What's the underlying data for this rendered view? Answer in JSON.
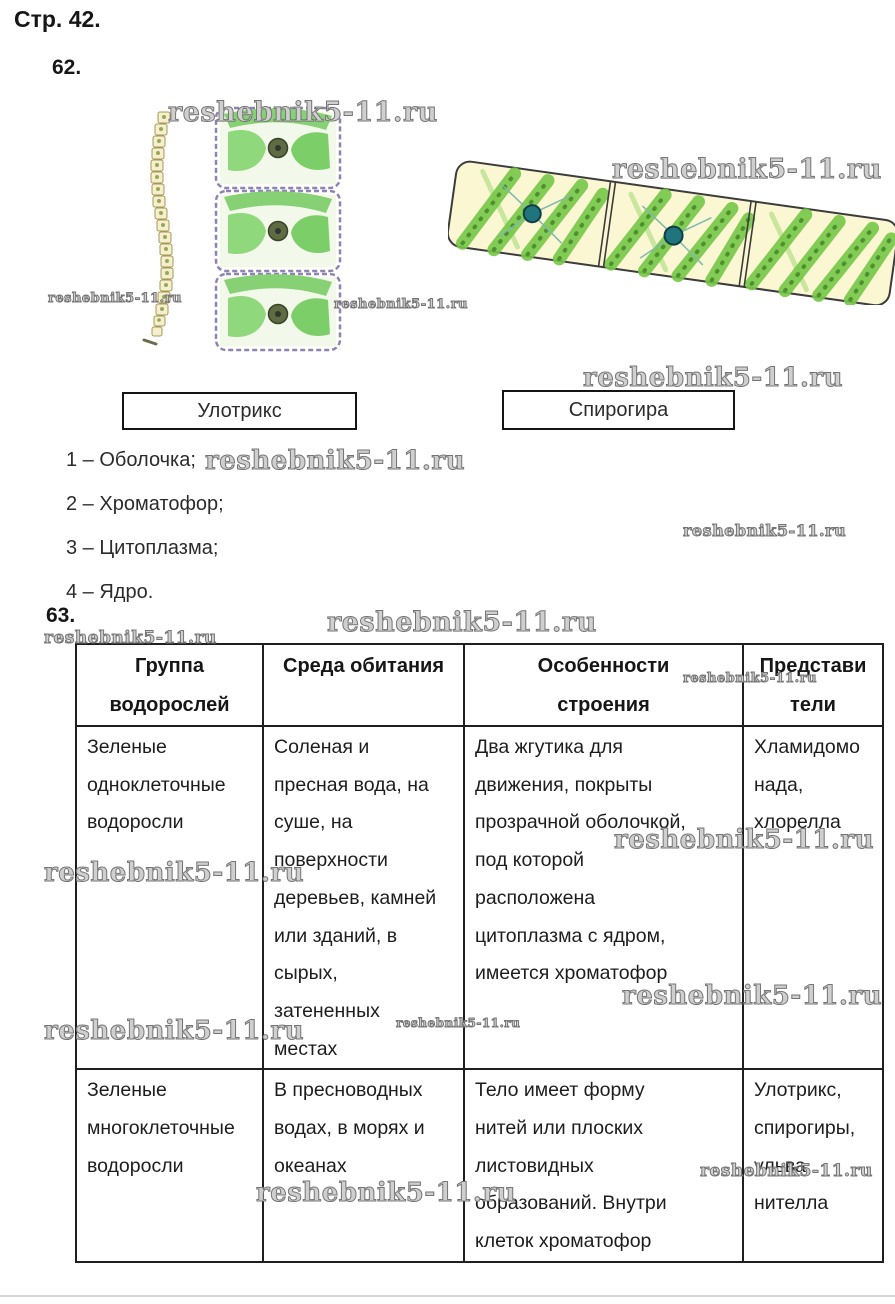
{
  "page": {
    "label": "Стр. 42."
  },
  "tasks": {
    "t62": "62.",
    "t63": "63."
  },
  "figures": {
    "ulothrix": {
      "caption": "Улотрикс"
    },
    "spirogyra": {
      "caption": "Спирогира"
    },
    "colors": {
      "chromatophore_green": "#76c747",
      "cell_wall_dark": "#3c3c3c",
      "cytoplasm_yellow": "#fbf7d2",
      "nucleus_teal": "#20747d",
      "nucleus_olive": "#5f6c41",
      "membrane_violet": "#8d84b5"
    }
  },
  "legend": {
    "items": [
      "1 – Оболочка;",
      "2 – Хроматофор;",
      "3 – Цитоплазма;",
      "4 – Ядро."
    ]
  },
  "watermark": {
    "text": "reshebnik5-11.ru",
    "color": "#8f8f8f",
    "positions": [
      {
        "x": 168,
        "y": 97,
        "s": 27
      },
      {
        "x": 48,
        "y": 291,
        "s": 13
      },
      {
        "x": 334,
        "y": 297,
        "s": 13
      },
      {
        "x": 612,
        "y": 154,
        "s": 27
      },
      {
        "x": 583,
        "y": 363,
        "s": 26
      },
      {
        "x": 205,
        "y": 446,
        "s": 26
      },
      {
        "x": 683,
        "y": 521,
        "s": 16
      },
      {
        "x": 327,
        "y": 607,
        "s": 27
      },
      {
        "x": 44,
        "y": 628,
        "s": 17
      },
      {
        "x": 683,
        "y": 671,
        "s": 13
      },
      {
        "x": 614,
        "y": 825,
        "s": 26
      },
      {
        "x": 44,
        "y": 858,
        "s": 26
      },
      {
        "x": 622,
        "y": 981,
        "s": 26
      },
      {
        "x": 396,
        "y": 1016,
        "s": 12
      },
      {
        "x": 44,
        "y": 1016,
        "s": 26
      },
      {
        "x": 700,
        "y": 1161,
        "s": 17
      },
      {
        "x": 256,
        "y": 1178,
        "s": 26
      }
    ]
  },
  "table": {
    "headers": [
      "Группа\nводорослей",
      "Среда обитания",
      "Особенности\nстроения",
      "Представи\nтели"
    ],
    "rows": [
      [
        "Зеленые\nодноклеточные\nводоросли",
        "Соленая и\nпресная вода, на\nсуше, на\nповерхности\nдеревьев, камней\nили зданий, в\nсырых,\nзатененных\nместах",
        "Два жгутика для\nдвижения, покрыты\nпрозрачной оболочкой,\nпод которой\nрасположена\nцитоплазма с ядром,\nимеется хроматофор",
        "Хламидомо\nнада,\nхлорелла"
      ],
      [
        "Зеленые\nмногоклеточные\nводоросли",
        "В пресноводных\nводах, в морях и\nокеанах",
        "Тело имеет форму\nнитей или плоских\nлистовидных\nобразований. Внутри\nклеток хроматофор",
        "Улотрикс,\nспирогиры,\nульва,\nнителла"
      ]
    ]
  }
}
